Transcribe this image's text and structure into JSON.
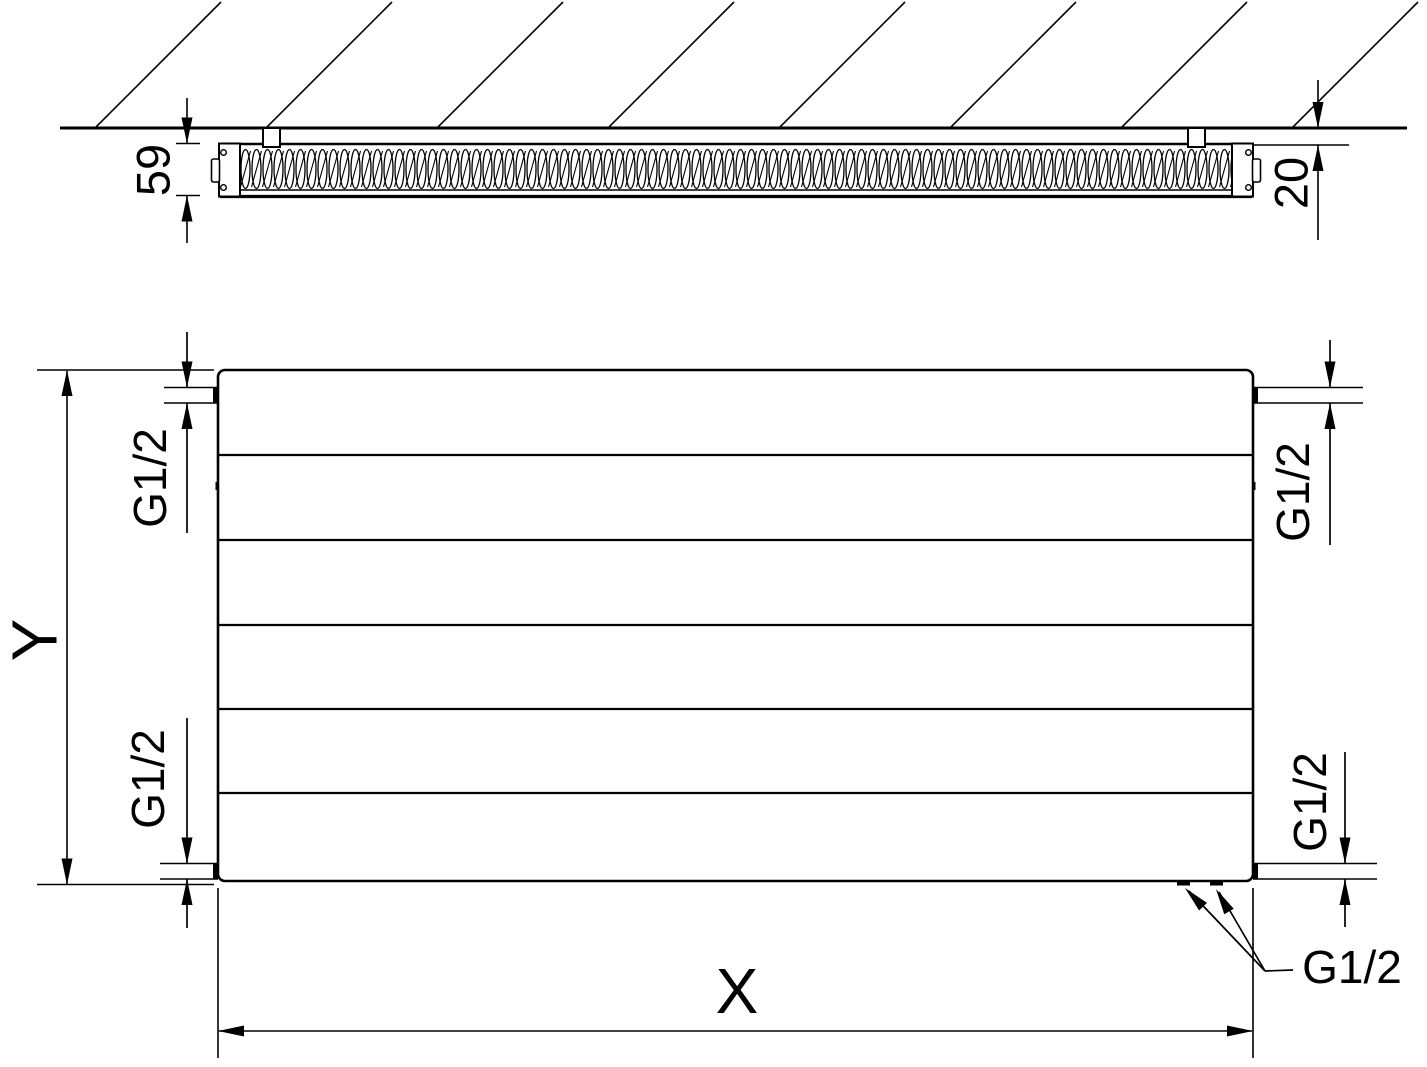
{
  "labels": {
    "depth": "59",
    "wall_clearance": "20",
    "height_axis": "Y",
    "width_axis": "X",
    "thread_top_left": "G1/2",
    "thread_bottom_left": "G1/2",
    "thread_top_right": "G1/2",
    "thread_bottom_right": "G1/2",
    "thread_bottom_callout": "G1/2"
  },
  "colors": {
    "line": "#000000",
    "background": "#ffffff"
  }
}
